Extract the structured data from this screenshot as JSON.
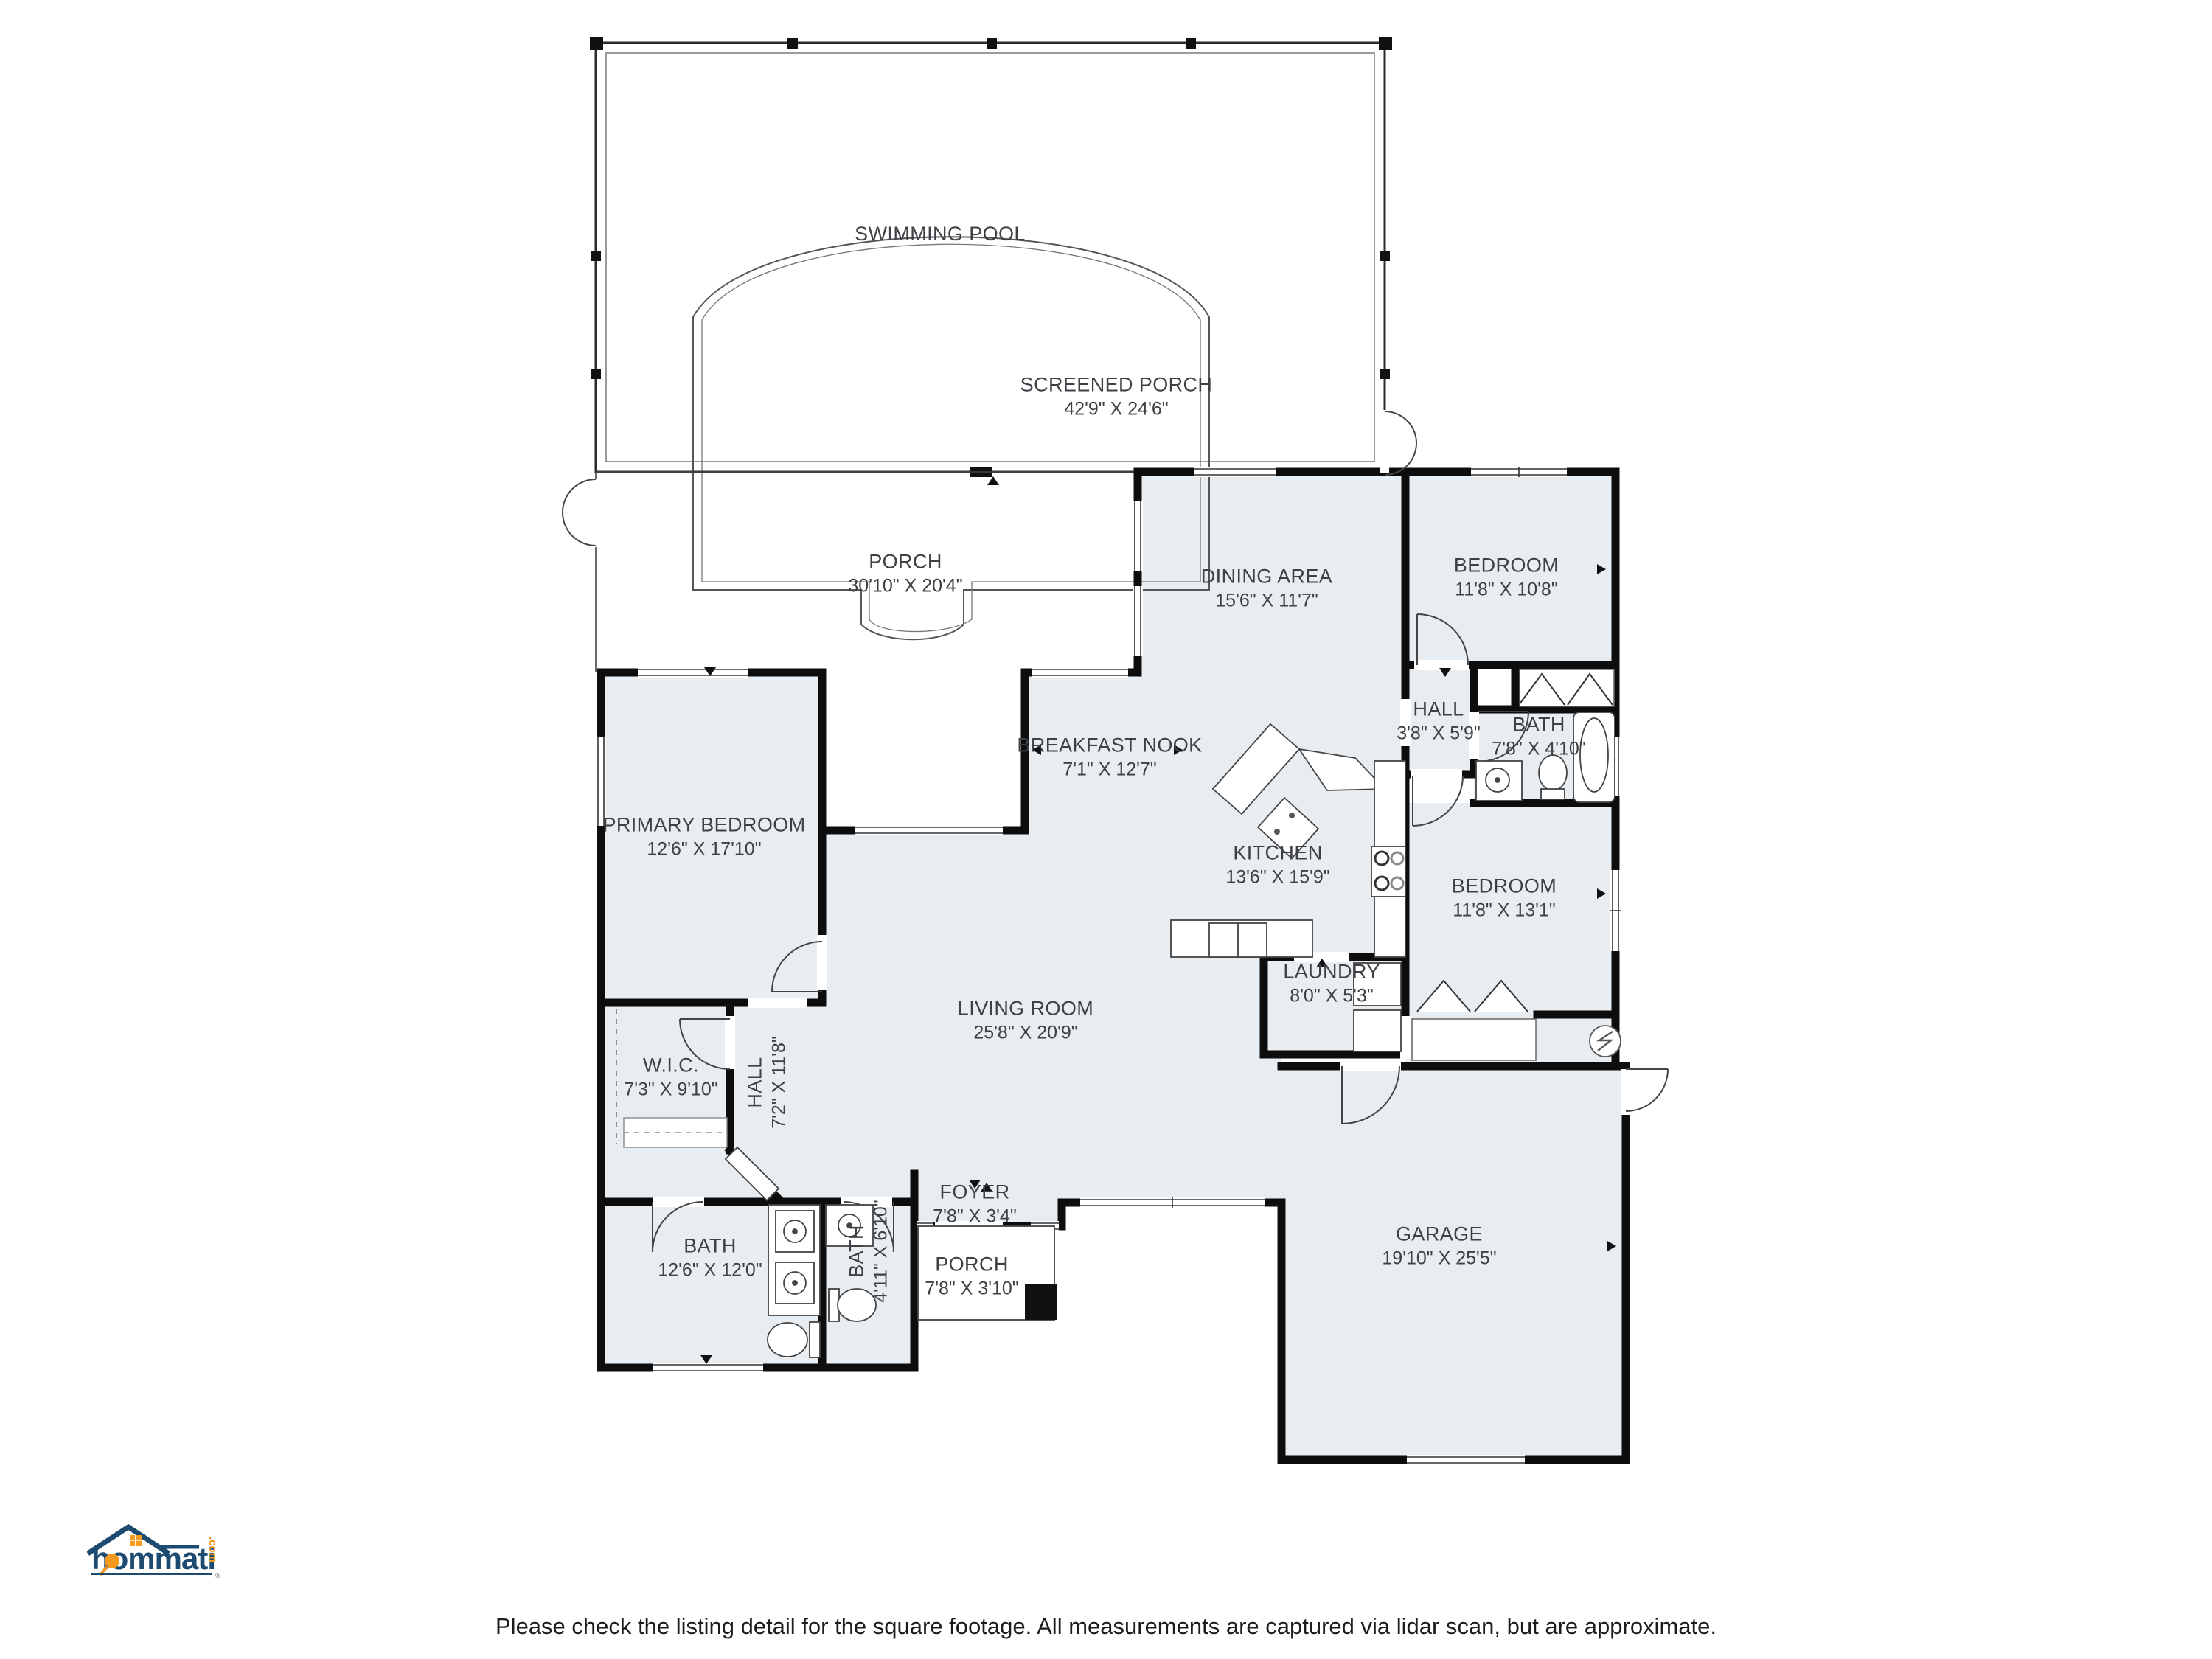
{
  "rooms": {
    "swimming_pool": {
      "label": "SWIMMING POOL",
      "dims": ""
    },
    "screened_porch": {
      "label": "SCREENED PORCH",
      "dims": "42'9\" X 24'6\""
    },
    "porch_back": {
      "label": "PORCH",
      "dims": "30'10\" X 20'4\""
    },
    "dining_area": {
      "label": "DINING AREA",
      "dims": "15'6\" X 11'7\""
    },
    "bedroom_ne": {
      "label": "BEDROOM",
      "dims": "11'8\" X 10'8\""
    },
    "hall_ne": {
      "label": "HALL",
      "dims": "3'8\" X 5'9\""
    },
    "bath_ne": {
      "label": "BATH",
      "dims": "7'8\" X 4'10\""
    },
    "breakfast_nook": {
      "label": "BREAKFAST NOOK",
      "dims": "7'1\" X 12'7\""
    },
    "kitchen": {
      "label": "KITCHEN",
      "dims": "13'6\" X 15'9\""
    },
    "primary_bedroom": {
      "label": "PRIMARY BEDROOM",
      "dims": "12'6\" X 17'10\""
    },
    "bedroom_e": {
      "label": "BEDROOM",
      "dims": "11'8\" X 13'1\""
    },
    "laundry": {
      "label": "LAUNDRY",
      "dims": "8'0\" X 5'3\""
    },
    "living_room": {
      "label": "LIVING ROOM",
      "dims": "25'8\" X 20'9\""
    },
    "wic": {
      "label": "W.I.C.",
      "dims": "7'3\" X 9'10\""
    },
    "hall_w": {
      "label": "HALL",
      "dims": "7'2\" X 11'8\""
    },
    "bath_w": {
      "label": "BATH",
      "dims": "12'6\" X 12'0\""
    },
    "bath_s": {
      "label": "BATH",
      "dims": "4'11\" X 6'10\""
    },
    "foyer": {
      "label": "FOYER",
      "dims": "7'8\" X 3'4\""
    },
    "porch_front": {
      "label": "PORCH",
      "dims": "7'8\" X 3'10\""
    },
    "garage": {
      "label": "GARAGE",
      "dims": "19'10\" X 25'5\""
    }
  },
  "colors": {
    "room_fill": "#e8edf1",
    "wall": "#0d0d0d",
    "brand_navy": "#1d4a70",
    "brand_orange": "#f5991f"
  },
  "logo": {
    "brand": "hommati",
    "tld": ".com",
    "registered": "®"
  },
  "footer": {
    "disclaimer": "Please check the listing detail for the square footage. All measurements are captured via lidar scan, but are approximate."
  }
}
